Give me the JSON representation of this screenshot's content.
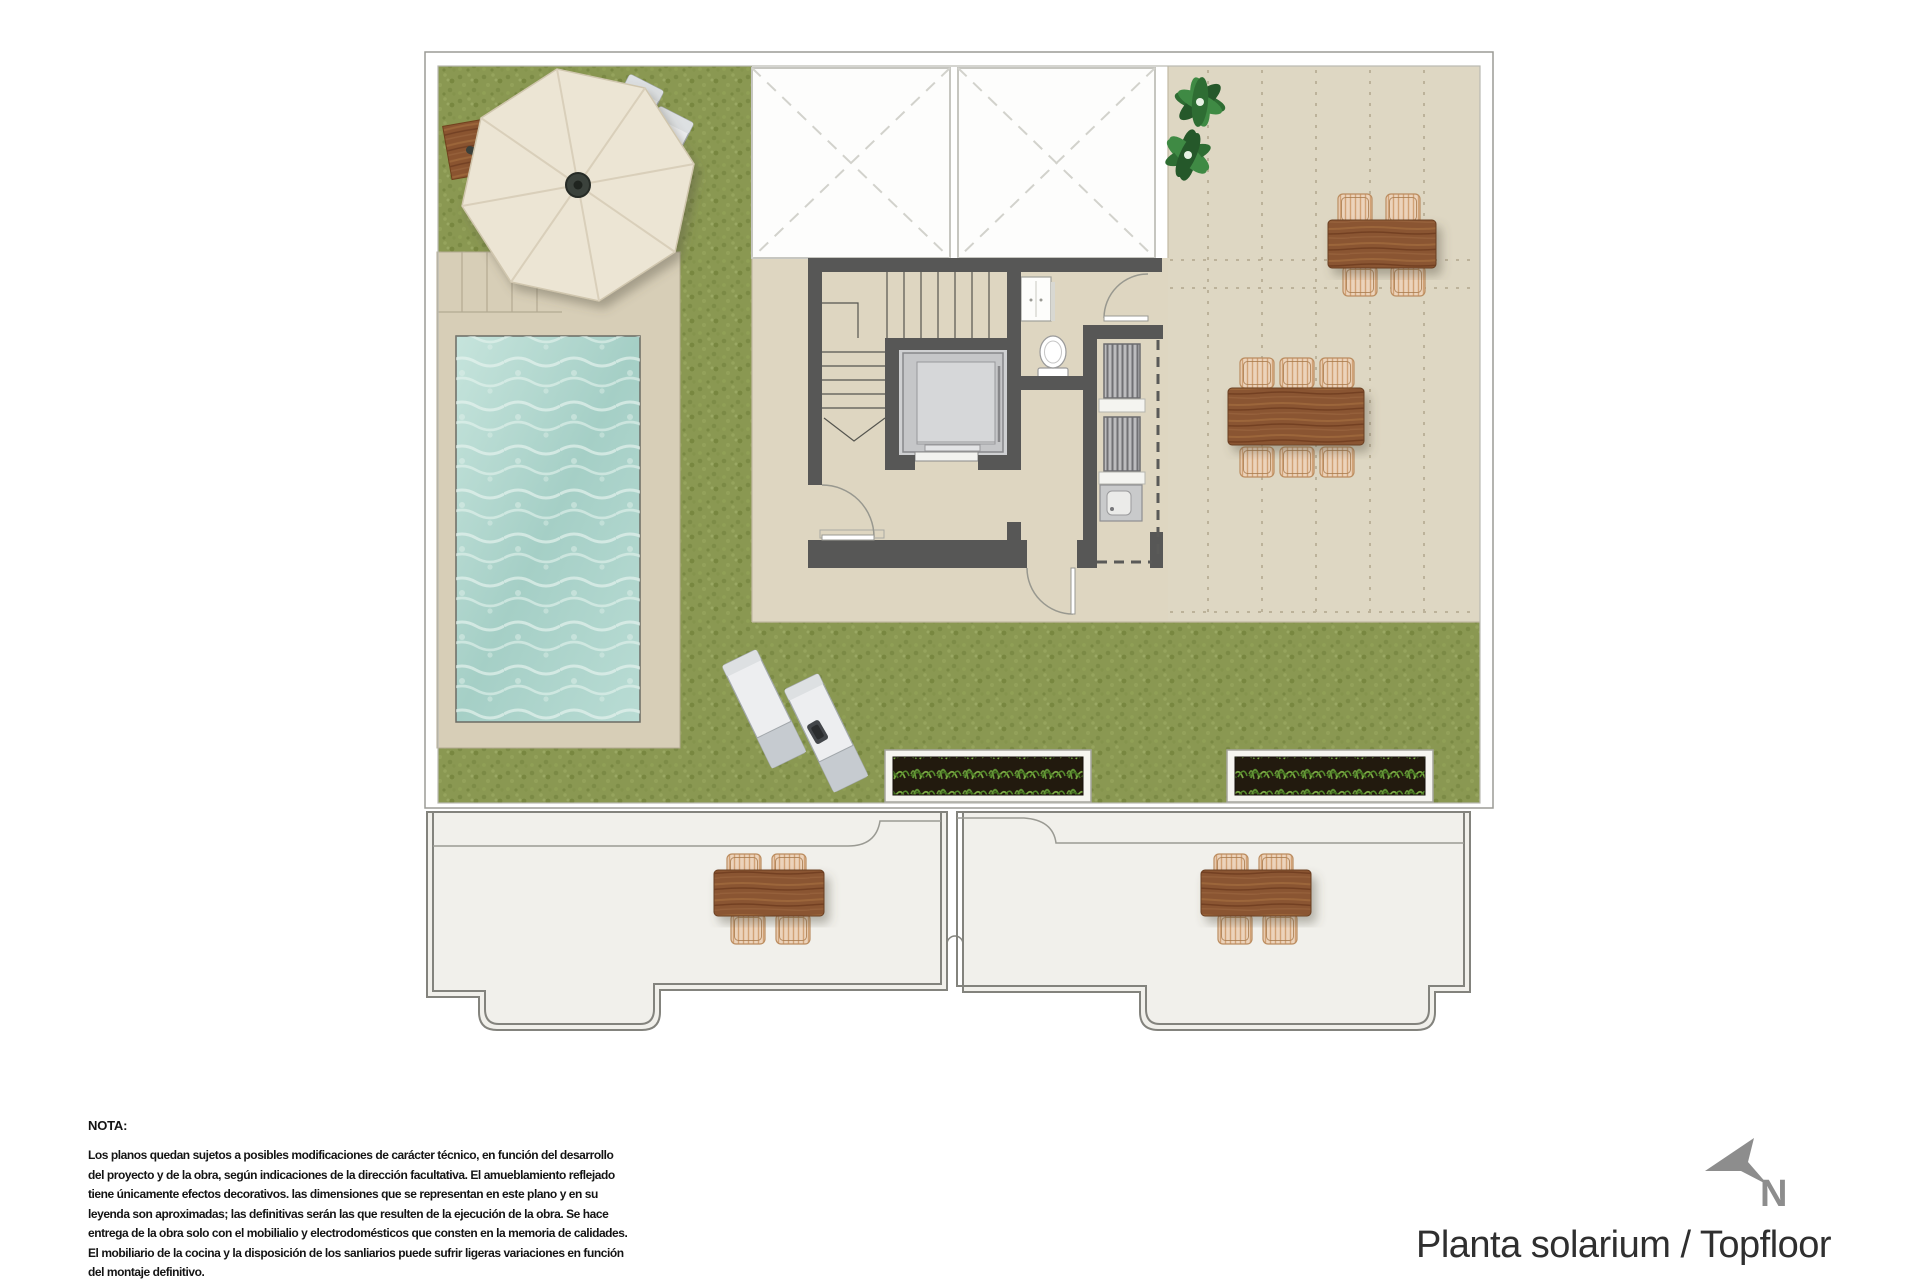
{
  "title": {
    "text": "Planta solarium / Topfloor"
  },
  "compass": {
    "label": "N"
  },
  "note": {
    "heading": "NOTA:",
    "lines": [
      "Los planos quedan sujetos a posibles modificaciones de carácter técnico, en función del desarrollo",
      "del proyecto y de la obra, según indicaciones de la dirección facultativa. El amueblamiento reflejado",
      "tiene únicamente efectos decorativos. las dimensiones que se representan en este plano y en su",
      "leyenda son aproximadas; las definitivas serán las que resulten de la ejecución de la obra. Se hace",
      "entrega de la obra solo con el mobilialio y electrodomésticos que consten en la memoria de calidades.",
      "El mobiliario de la cocina y la disposición de los sanliarios puede sufrir ligeras variaciones en función",
      "del montaje definitivo."
    ]
  },
  "colors": {
    "grass": "#8a9852",
    "floor_beige": "#ded6c1",
    "terrace_beige": "#ded7c3",
    "pool_deck": "#d7ceb7",
    "water": "#aed3ca",
    "wall": "#575756",
    "wood": "#8a5430",
    "wicker": "#ecd3bb",
    "lower_floor": "#f1f0eb",
    "title_text": "#2f2f2f",
    "north_gray": "#8d8d8d"
  }
}
